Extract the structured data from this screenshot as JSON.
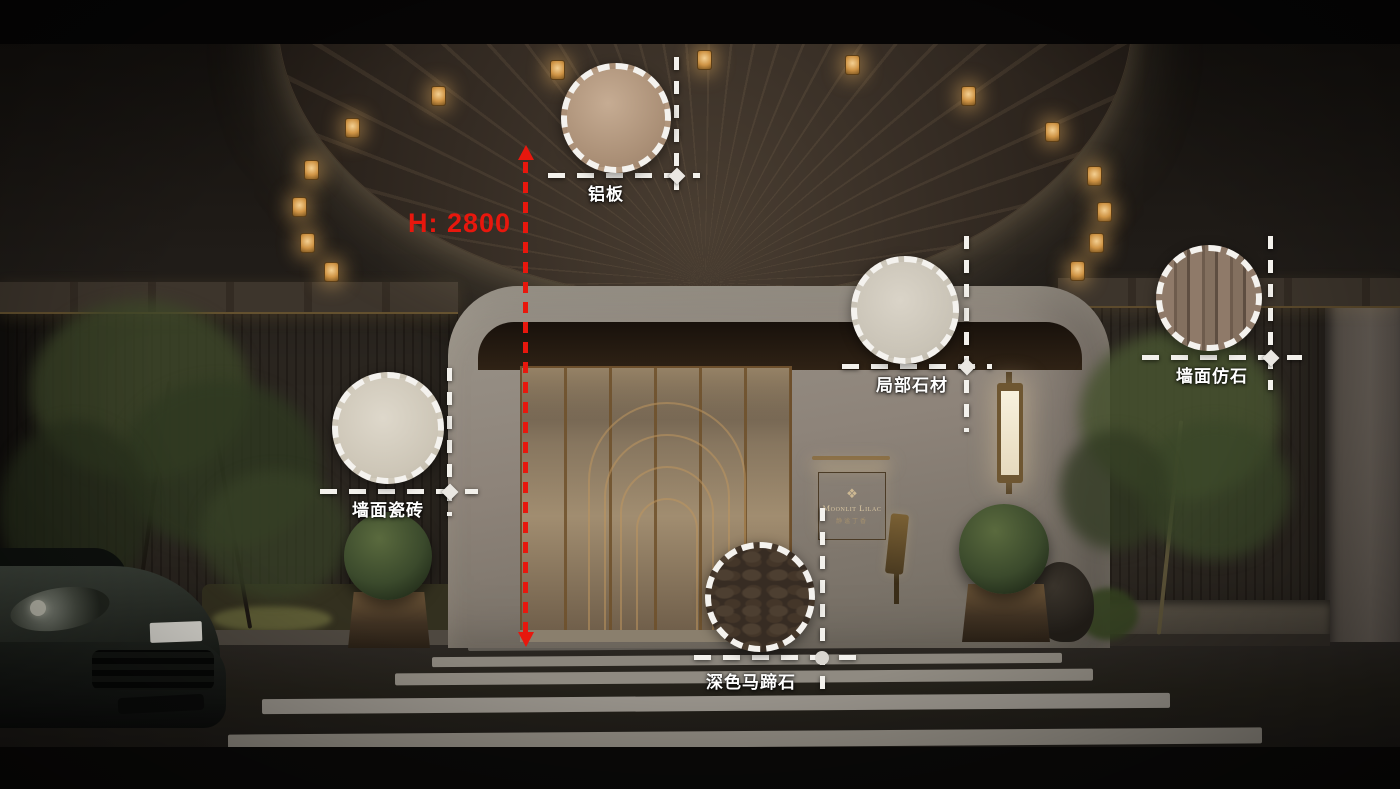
{
  "colors": {
    "annotation_red": "#e8170d",
    "annotation_white": "#f3f1ec",
    "brand_gold": "#d8c6a2"
  },
  "dimension": {
    "label": "H: 2800"
  },
  "materials": [
    {
      "id": "aluminum-panel",
      "label": "铝板"
    },
    {
      "id": "partial-stone",
      "label": "局部石材"
    },
    {
      "id": "faux-stone-wall",
      "label": "墙面仿石"
    },
    {
      "id": "ceramic-tile-wall",
      "label": "墙面瓷砖"
    },
    {
      "id": "dark-cobblestone",
      "label": "深色马蹄石"
    }
  ],
  "sign": {
    "logo": "❖",
    "brand": "Moonlit Lilac",
    "brand_cn": "静谧丁香"
  }
}
